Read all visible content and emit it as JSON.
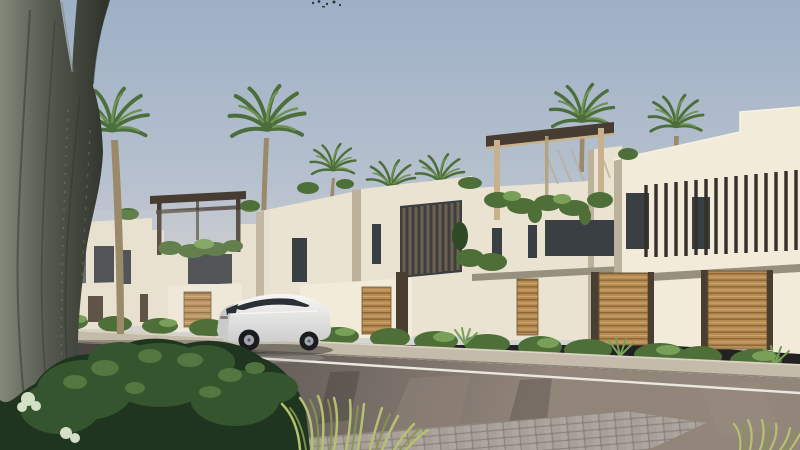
{
  "scene": {
    "type": "architectural-render",
    "description": "Street view of a modern white villa community at dusk: a receding row of cubic villas with rooftop pergolas, vertical louver screens and wooden slat garage panels, palm trees, a large foreground tree trunk, lush shrubs and ornamental grass, and a white luxury SUV parked on a wet reflective asphalt road",
    "objects": [
      "sky",
      "birds",
      "palm-trees",
      "villa-row",
      "rooftop-pergolas",
      "louver-screens",
      "garage-wood-panels",
      "hedges",
      "sidewalk",
      "wet-road",
      "lane-marking",
      "paver-band",
      "white-suv",
      "foreground-tree",
      "foreground-bush",
      "ornamental-grass"
    ]
  },
  "colors": {
    "sky_top": "#9db0c6",
    "sky_mid": "#b7c1ce",
    "sky_horizon": "#d5d5d2",
    "haze": "#dcd8cf",
    "wall_bright": "#f2ebda",
    "wall_lit": "#eae3d1",
    "wall_mid": "#d8d0bc",
    "wall_shadow": "#bcb29c",
    "wall_dark": "#9c9280",
    "gray_volume": "#5c5f5a",
    "window_dark": "#3a3f44",
    "slat_dark": "#342f28",
    "louver_brown": "#70604a",
    "wood_door": "#b78c53",
    "wood_door_dark": "#8a6637",
    "wood_door_light": "#d0a670",
    "pergola_dark": "#463c31",
    "pergola_light": "#c8b28c",
    "palm_green": "#6f9254",
    "palm_green_dark": "#4c6e3a",
    "palm_trunk": "#9a8a6a",
    "hedge_green": "#4e7038",
    "hedge_light": "#78a058",
    "hedge_dark": "#2e4a24",
    "bush_dark": "#1f3520",
    "bush_mid": "#35552f",
    "bush_light": "#567b43",
    "flower": "#dde8d0",
    "grass_light": "#b6c170",
    "grass_dark": "#84994c",
    "bark_light": "#83887a",
    "bark_mid": "#555a50",
    "bark_dark": "#30342c",
    "sidewalk": "#c4bbaa",
    "curb_light": "#dcd4c2",
    "curb_dark": "#8e8678",
    "road_dark": "#514d49",
    "road_mid": "#6d6560",
    "road_light": "#92857a",
    "lane_line": "#ebe8df",
    "paver": "#a8a098",
    "paver_joint": "#8b847c",
    "car_body": "#ededeb",
    "car_body_shade": "#c9cbca",
    "car_glass": "#2b3036",
    "car_tire": "#191b1d",
    "car_rim": "#a0a6ac",
    "bird": "#2f3338"
  }
}
